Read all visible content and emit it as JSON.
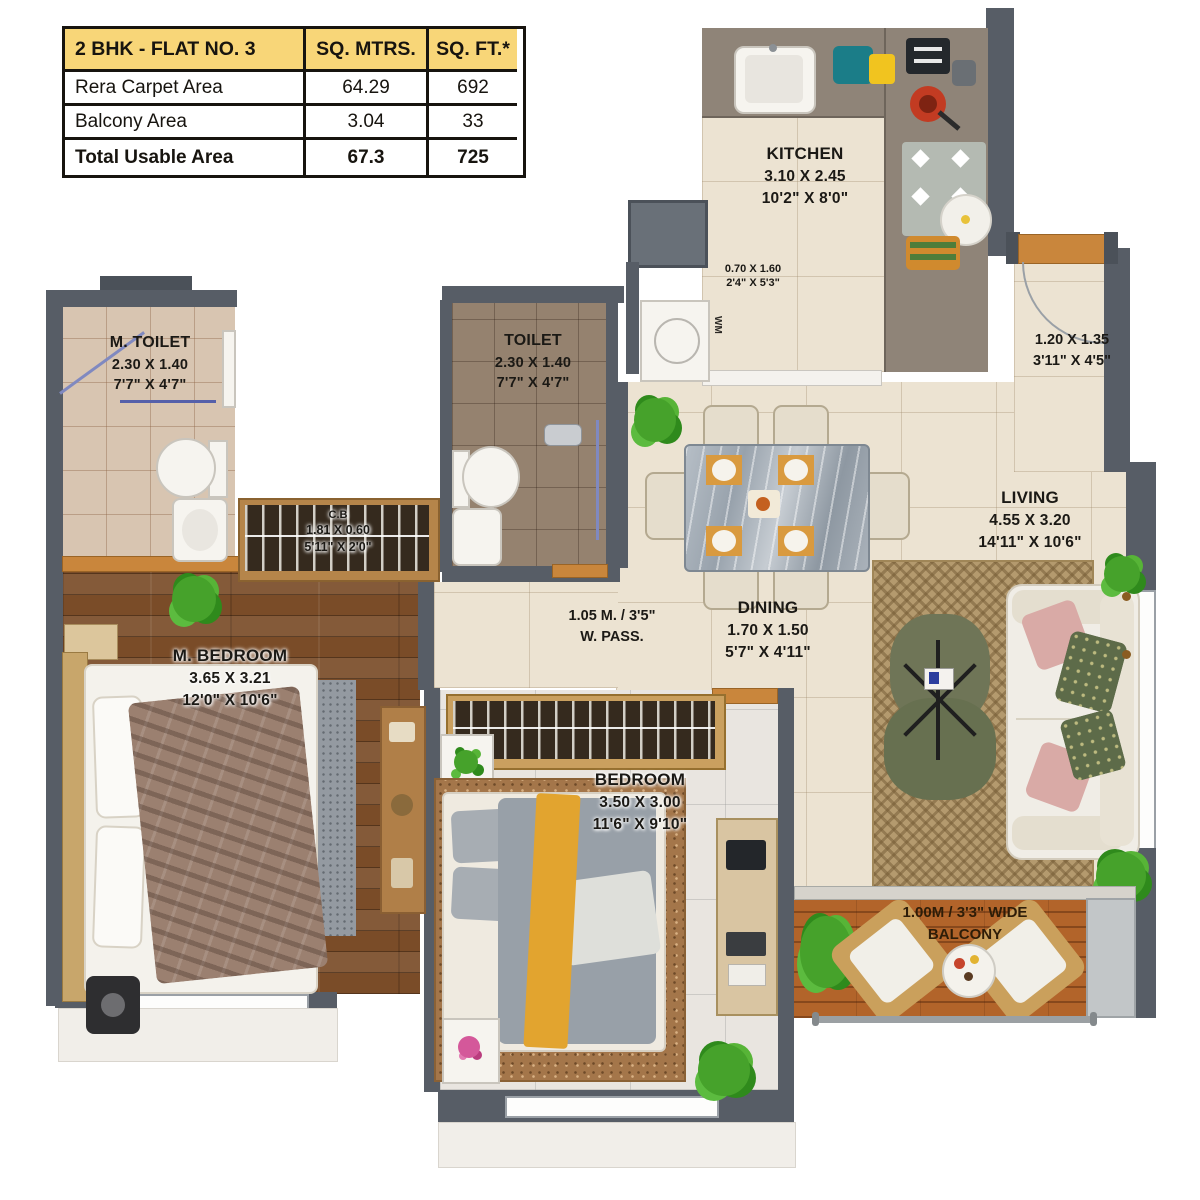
{
  "area_table": {
    "title": "2 BHK - FLAT NO. 3",
    "col_sqm": "SQ. MTRS.",
    "col_sqft": "SQ. FT.*",
    "rows": [
      {
        "label": "Rera Carpet Area",
        "sqm": "64.29",
        "sqft": "692"
      },
      {
        "label": "Balcony Area",
        "sqm": "3.04",
        "sqft": "33"
      },
      {
        "label": "Total Usable Area",
        "sqm": "67.3",
        "sqft": "725"
      }
    ]
  },
  "labels": {
    "kitchen": {
      "name": "KITCHEN",
      "metric": "3.10 X 2.45",
      "imperial": "10'2\" X 8'0\""
    },
    "utility": {
      "metric": "0.70 X 1.60",
      "imperial": "2'4\" X 5'3\""
    },
    "wm": "WM",
    "m_toilet": {
      "name": "M. TOILET",
      "metric": "2.30 X 1.40",
      "imperial": "7'7\" X 4'7\""
    },
    "toilet": {
      "name": "TOILET",
      "metric": "2.30 X 1.40",
      "imperial": "7'7\" X 4'7\""
    },
    "foyer": {
      "metric": "1.20 X 1.35",
      "imperial": "3'11\" X 4'5\""
    },
    "cb": {
      "name": "C.B",
      "metric": "1.81 X 0.60",
      "imperial": "5'11\" X 2'0\""
    },
    "dining": {
      "name": "DINING",
      "metric": "1.70 X 1.50",
      "imperial": "5'7\" X 4'11\""
    },
    "living": {
      "name": "LIVING",
      "metric": "4.55 X 3.20",
      "imperial": "14'11\" X 10'6\""
    },
    "passage": {
      "line1": "1.05 M. / 3'5\"",
      "line2": "W. PASS."
    },
    "m_bedroom": {
      "name": "M. BEDROOM",
      "metric": "3.65 X 3.21",
      "imperial": "12'0\" X 10'6\""
    },
    "bedroom": {
      "name": "BEDROOM",
      "metric": "3.50 X 3.00",
      "imperial": "11'6\" X 9'10\""
    },
    "balcony": {
      "line1": "1.00M / 3'3\" WIDE",
      "line2": "BALCONY"
    }
  },
  "colors": {
    "header_yellow": "#f8d678",
    "wall_gray": "#575d66",
    "wood_accent": "#c9863c",
    "deck_wood": "#b2642a",
    "mustard": "#e2a42f",
    "rug_tan": "#b49a6e"
  }
}
